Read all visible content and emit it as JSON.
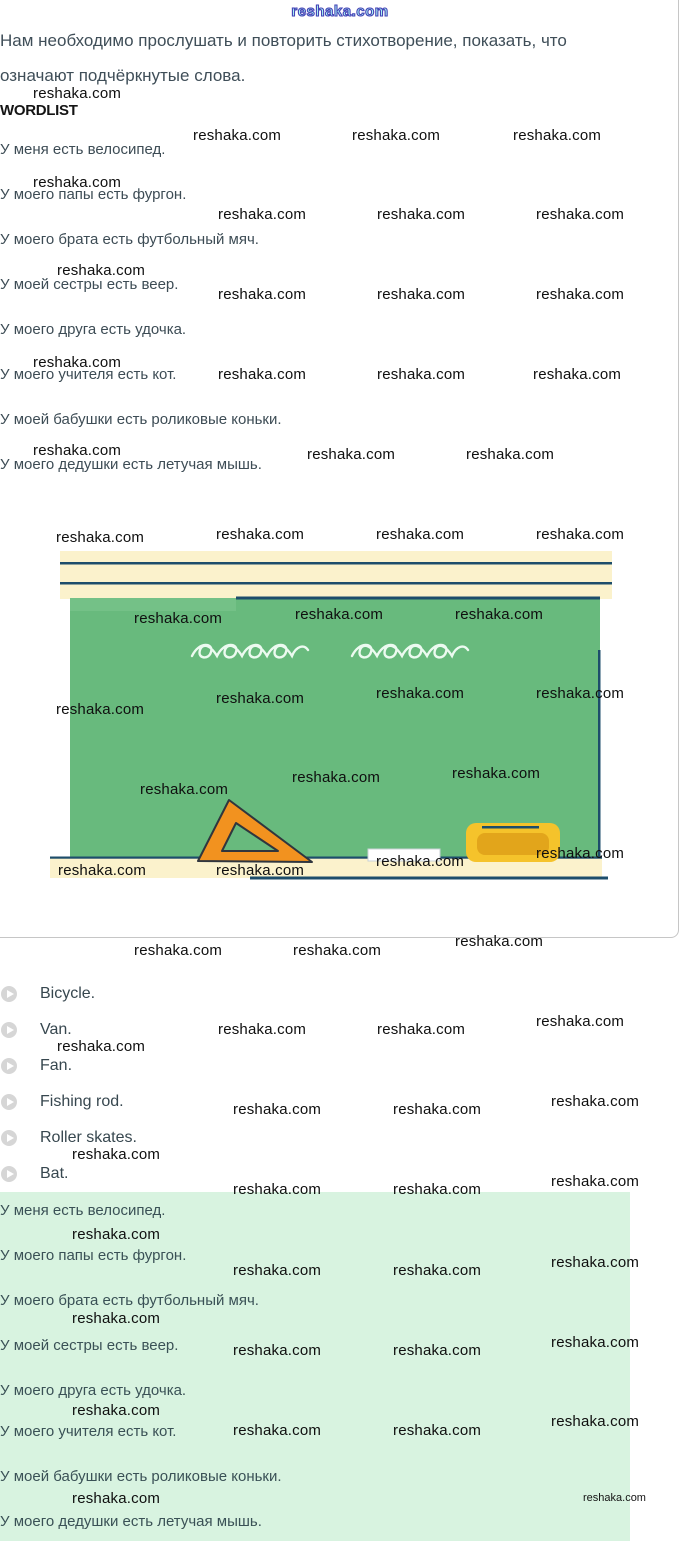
{
  "brand": {
    "watermark": "reshaka.com",
    "watermark_outlined": "reshaka.com",
    "watermark_small": "reshaka.com"
  },
  "task": {
    "instruction_line1": "Нам необходимо прослушать и повторить стихотворение, показать, что",
    "instruction_line2": "означают подчёркнутые слова.",
    "wordlist_label": "WORDLIST",
    "sentences": [
      "У меня есть велосипед.",
      "У моего папы есть фургон.",
      "У моего брата есть футбольный мяч.",
      "У моей сестры есть веер.",
      "У моего друга есть удочка.",
      "У моего учителя есть кот.",
      "У моей бабушки есть роликовые коньки.",
      "У моего дедушки есть летучая мышь."
    ]
  },
  "illustration": {
    "description": "green chalkboard with white doodles, orange triangle ruler, white chalk and yellow board eraser on a tray"
  },
  "audio_list": {
    "items": [
      "Bicycle.",
      "Van.",
      "Fan.",
      "Fishing rod.",
      "Roller skates.",
      "Bat."
    ]
  },
  "answer": {
    "sentences": [
      "У меня есть велосипед.",
      "У моего папы есть фургон.",
      "У моего брата есть футбольный мяч.",
      "У моей сестры есть веер.",
      "У моего друга есть удочка.",
      "У моего учителя есть кот.",
      "У моей бабушки есть роликовые коньки.",
      "У моего дедушки есть летучая мышь."
    ]
  },
  "colors": {
    "chalkboard_green": "#68ba7d",
    "banner_cream": "#fbf2cc",
    "line_navy": "#1d4d6b",
    "ruler_orange": "#f2921f",
    "eraser_yellow": "#f5c32b",
    "eraser_inner": "#e2a51b",
    "answer_highlight": "#d8f3e0",
    "body_text": "#3d4c55",
    "watermark_black": "#0f0f0f",
    "watermark_cyan": "#aefaf5",
    "watermark_outline": "#4343b6"
  }
}
